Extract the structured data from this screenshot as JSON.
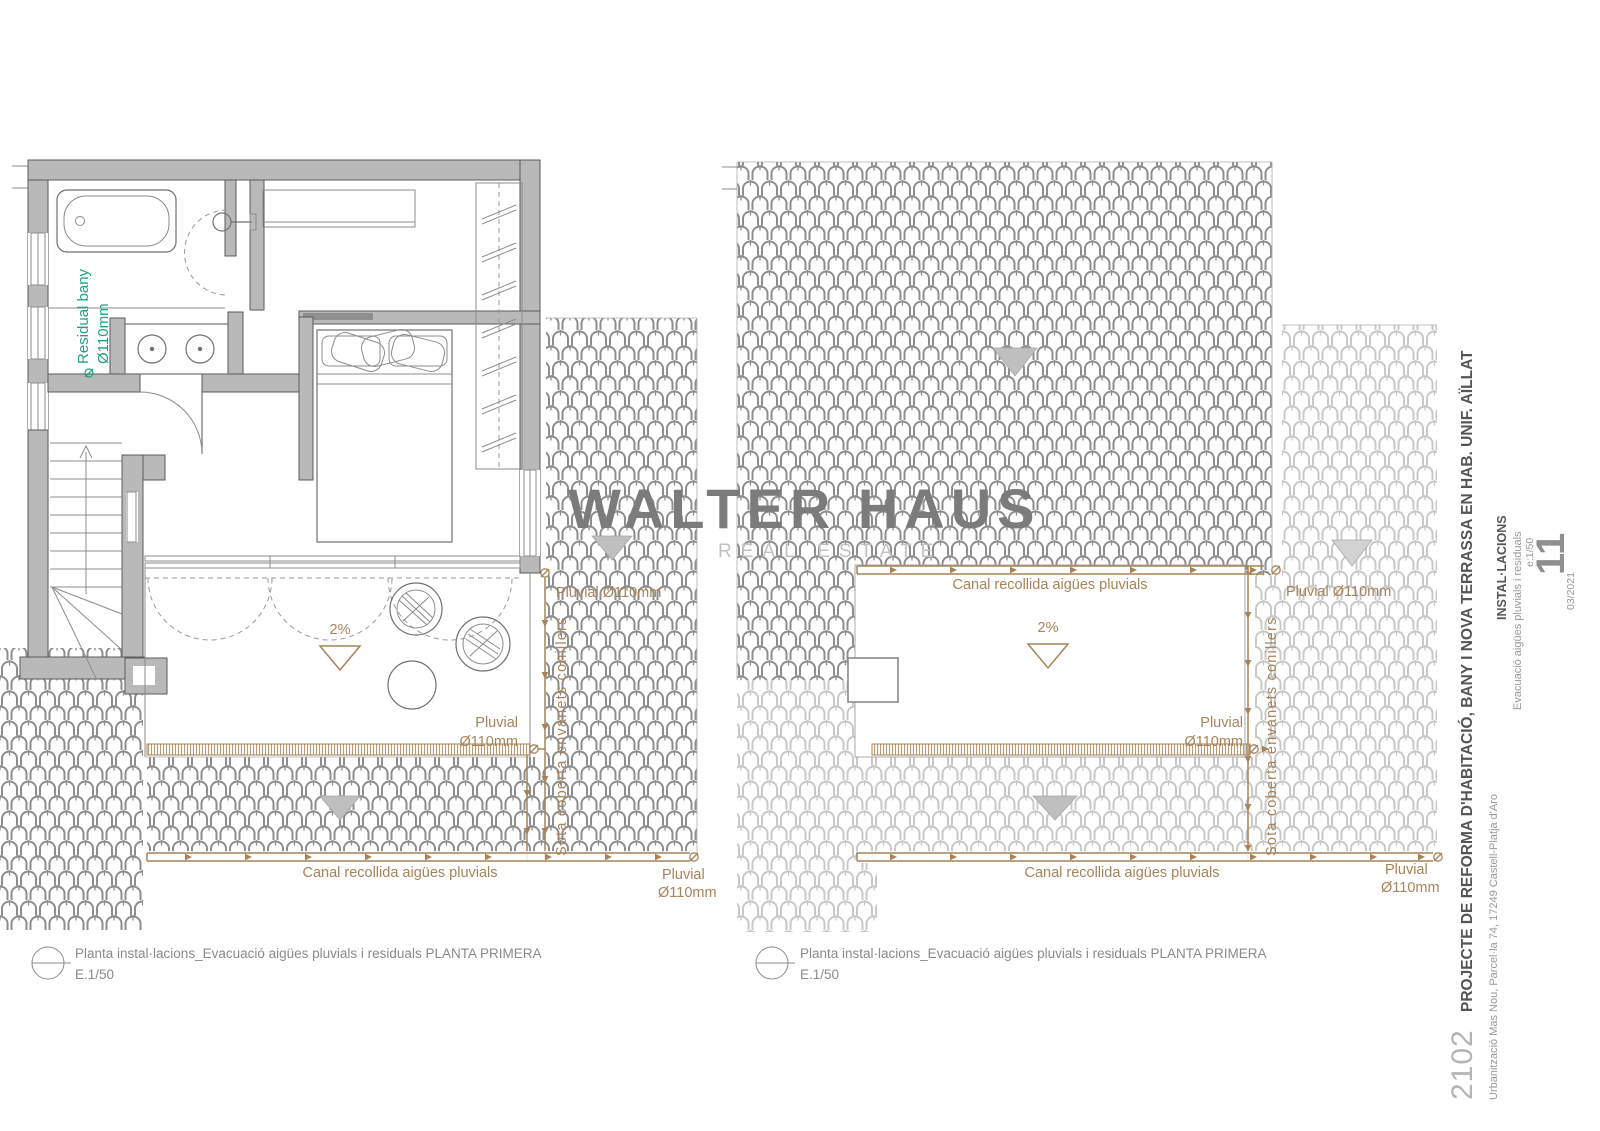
{
  "watermark": {
    "title": "WALTER HAUS",
    "subtitle": "REAL ESTATE"
  },
  "annotations": {
    "canal_label": "Canal recollida aigües pluvials",
    "pluvial": "Pluvial",
    "diameter": "Ø110mm",
    "pluvial_inline": "Pluvial Ø110mm",
    "slope": "2%",
    "under_roof": "Sota coberta envanets conillers",
    "residual_line1": "Residual bany",
    "residual_line2": "Ø110mm"
  },
  "captions": {
    "left": {
      "title": "Planta instal·lacions_Evacuació aigües pluvials i residuals PLANTA PRIMERA",
      "scale": "E.1/50"
    },
    "right": {
      "title": "Planta instal·lacions_Evacuació aigües pluvials i residuals PLANTA PRIMERA",
      "scale": "E.1/50"
    }
  },
  "title_block": {
    "project_number": "2102",
    "project_title": "PROJECTE DE REFORMA D'HABITACIÓ, BANY I NOVA TERRASSA EN HAB. UNIF. AÏLLAT",
    "address": "Urbanització Mas Nou, Parcel·la 74, 17249 Castell-Platja d'Aro",
    "discipline": "INSTAL·LACIONS",
    "drawing_title": "Evacuació aigües pluvials i residuals",
    "scale": "e:1/50",
    "sheet_number": "11",
    "date": "03/2021"
  },
  "colors": {
    "annotation_brown": "#a6835a",
    "hatch_brown": "#b79a6e",
    "residual_green": "#21a184",
    "tile_dark": "#8d8d8d",
    "tile_light": "#c8c8c8",
    "wall_fill": "#b9b9b9",
    "watermark_gray": "#7b7b7b",
    "watermark_sub_gray": "#c2c2c2",
    "caption_gray": "#8a8a8a",
    "title_dark": "#555555"
  }
}
